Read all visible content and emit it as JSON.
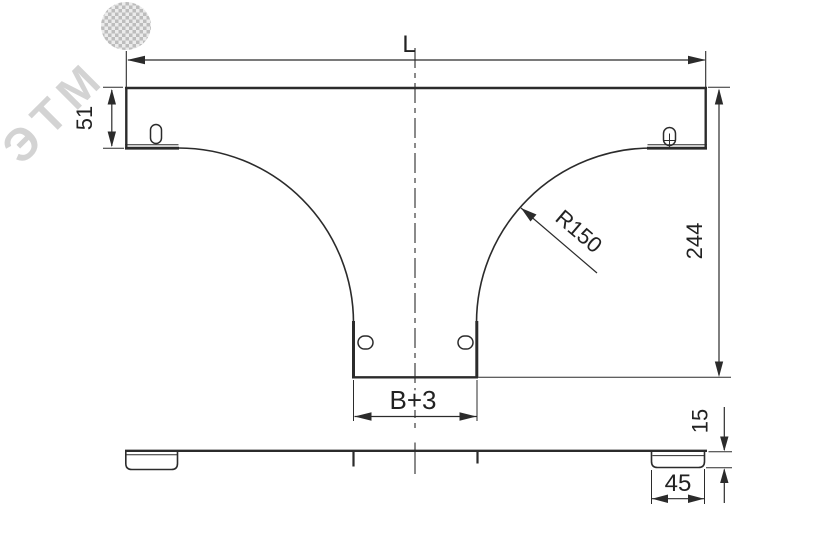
{
  "watermark": {
    "text": "ЭТМ"
  },
  "colors": {
    "line": "#2b2b2b",
    "background": "#ffffff",
    "watermark": "#c9c9c9"
  },
  "top_view": {
    "length_label": "L",
    "flange_height_label": "51",
    "height_label": "244",
    "radius_label": "R150",
    "branch_width_label": "B+3"
  },
  "side_view": {
    "profile_height_label": "15",
    "tab_width_label": "45"
  }
}
